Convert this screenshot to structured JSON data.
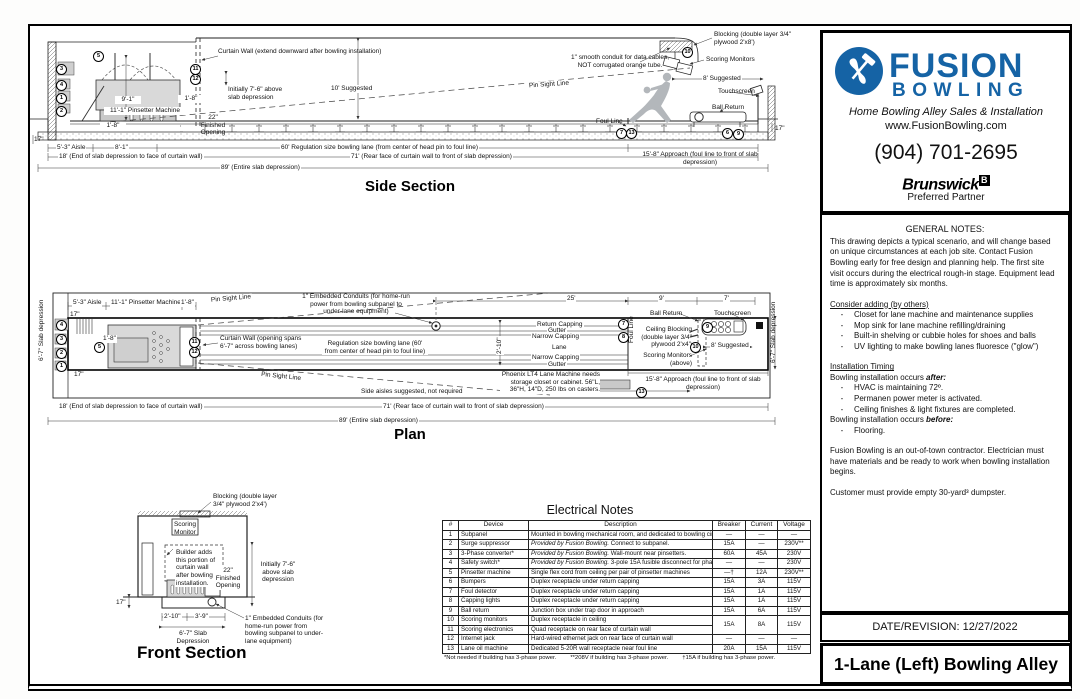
{
  "callouts": {
    "c1": "1",
    "c2": "2",
    "c3": "3",
    "c4": "4",
    "c5": "5",
    "c6": "6",
    "c7": "7",
    "c8": "8",
    "c9": "9",
    "c10": "10",
    "c11": "11",
    "c12": "12",
    "c13": "13"
  },
  "side": {
    "title": "Side Section",
    "curtain_wall": "Curtain Wall (extend downward after bowling installation)",
    "initially": "Initially 7'-6\" above slab depression",
    "dim_9_1": "9'-1\"",
    "pinsetter": "11'-1\" Pinsetter Machine",
    "gap_1_8": "1'-8\"",
    "pit_1_8": "1'-8\"",
    "finished_opening": "22\" Finished Opening",
    "suggested_10": "10' Suggested",
    "pin_sight": "Pin Sight Line",
    "conduit_note": "1\" smooth conduit for data cables, NOT corrugated orange tube.",
    "blocking": "Blocking (double layer 3/4\" plywood 2'x8')",
    "scoring_monitors": "Scoring Monitors",
    "suggested_8": "8' Suggested",
    "touchscreen": "Touchscreen",
    "ball_return": "Ball Return",
    "foul_line": "Foul Line",
    "dim_17_left": "17\"",
    "dim_17_right": "17\"",
    "aisle": "5'-3\" Aisle",
    "dim_8_1": "8'-1\"",
    "lane_60": "60' Regulation size bowling lane (from center of head pin to foul line)",
    "approach": "15'-8\" Approach (foul line to front of slab depression)",
    "dim_18": "18' (End of slab depression to face of curtain wall)",
    "dim_71": "71' (Rear face of curtain wall to front of slab depression)",
    "dim_89": "89' (Entire slab depression)"
  },
  "plan": {
    "title": "Plan",
    "aisle": "5'-3\" Aisle",
    "pinsetter": "11'-1\" Pinsetter Machine",
    "gap_1_8": "1'-8\"",
    "pit_1_8": "1'-8\"",
    "slab_left": "6'-7\" Slab depression",
    "slab_right": "6'-7\" Slab depression",
    "dim_17_top": "17\"",
    "dim_17_bottom": "17\"",
    "pin_sight_upper": "Pin Sight Line",
    "pin_sight_lower": "Pin Sight Line",
    "curtain_wall": "Curtain Wall (opening spans 6'-7\" across bowling lanes)",
    "conduits": "1\" Embedded Conduits (for home-run power from bowling subpanel to under-lane equipment)",
    "dim_25": "25'",
    "dim_9": "9'",
    "dim_7": "7'",
    "return_capping": "Return Capping",
    "gutter_top": "Gutter",
    "narrow_top": "Narrow Capping",
    "lane": "Lane",
    "narrow_bottom": "Narrow Capping",
    "gutter_bottom": "Gutter",
    "reg_lane": "Regulation size bowling lane (60' from center of head pin to foul line)",
    "dim_2_10": "2'-10\"",
    "ball_return": "Ball Return",
    "touchscreen": "Touchscreen",
    "ceiling_blocking": "Ceiling Blocking (double layer 3/4\" plywood 2'x4')",
    "suggested_8": "8' Suggested",
    "scoring_monitors": "Scoring Monitors (above)",
    "foul_line": "Foul Line",
    "approach": "15'-8\" Approach (foul line to front of slab depression)",
    "side_aisles": "Side aisles suggested, not required",
    "phoenix": "Phoenix LT4 Lane Machine needs storage closet or cabinet. 56\"L, 36\"H, 14\"D, 250 lbs on casters.",
    "dim_18": "18' (End of slab depression to face of curtain wall)",
    "dim_71": "71' (Rear face of curtain wall to front of slab depression)",
    "dim_89": "89' (Entire slab depression)"
  },
  "front": {
    "title": "Front Section",
    "blocking": "Blocking (double layer 3/4\" plywood 2'x4')",
    "scoring_monitor": "Scoring Monitor",
    "builder": "Builder adds this portion of curtain wall after bowling installation.",
    "initially": "Initially 7'-6\" above slab depression",
    "finished": "22\" Finished Opening",
    "dim_17": "17\"",
    "dim_2_10": "2'-10\"",
    "dim_3_9": "3'-9\"",
    "slab": "6'-7\" Slab Depression",
    "conduits": "1\" Embedded Conduits (for home-run power from bowling subpanel to under-lane equipment)"
  },
  "electrical": {
    "title": "Electrical Notes",
    "headers": [
      "#",
      "Device",
      "Description",
      "Breaker",
      "Current",
      "Voltage"
    ],
    "rows": [
      {
        "num": "1",
        "device": "Subpanel",
        "desc": "Mounted in bowling mechanical room, and dedicated to bowling circuits only",
        "breaker": "—",
        "current": "—",
        "voltage": "—"
      },
      {
        "num": "2",
        "device": "Surge suppressor",
        "desc_i": "Provided by Fusion Bowling.",
        "desc": " Connect to subpanel.",
        "breaker": "15A",
        "current": "—",
        "voltage": "230V**"
      },
      {
        "num": "3",
        "device": "3-Phase converter*",
        "desc_i": "Provided by Fusion Bowling.",
        "desc": " Wall-mount near pinsetters.",
        "breaker": "60A",
        "current": "45A",
        "voltage": "230V"
      },
      {
        "num": "4",
        "device": "Safety switch*",
        "desc_i": "Provided by Fusion Bowling.",
        "desc": " 3-pole 15A fusible disconnect for phase converter",
        "breaker": "—",
        "current": "—",
        "voltage": "230V"
      },
      {
        "num": "5",
        "device": "Pinsetter machine",
        "desc": "Single flex cord from ceiling per pair of pinsetter machines",
        "breaker": "—†",
        "current": "12A",
        "voltage": "230V**"
      },
      {
        "num": "6",
        "device": "Bumpers",
        "desc": "Duplex receptacle under return capping",
        "breaker": "15A",
        "current": "3A",
        "voltage": "115V"
      },
      {
        "num": "7",
        "device": "Foul detector",
        "desc": "Duplex receptacle under return capping",
        "breaker": "15A",
        "current": "1A",
        "voltage": "115V"
      },
      {
        "num": "8",
        "device": "Capping lights",
        "desc": "Duplex receptacle under return capping",
        "breaker": "15A",
        "current": "1A",
        "voltage": "115V"
      },
      {
        "num": "9",
        "device": "Ball return",
        "desc": "Junction box under trap door in approach",
        "breaker": "15A",
        "current": "6A",
        "voltage": "115V"
      },
      {
        "num": "10",
        "device": "Scoring monitors",
        "desc": "Duplex receptacle in ceiling",
        "breaker": "15A",
        "current": "8A",
        "voltage": "115V"
      },
      {
        "num": "11",
        "device": "Scoring electronics",
        "desc": "Quad receptacle on rear face of curtain wall"
      },
      {
        "num": "12",
        "device": "Internet jack",
        "desc": "Hard-wired ethernet jack on rear face of curtain wall",
        "breaker": "—",
        "current": "—",
        "voltage": "—"
      },
      {
        "num": "13",
        "device": "Lane oil machine",
        "desc": "Dedicated 5-20R wall receptacle near foul line",
        "breaker": "20A",
        "current": "15A",
        "voltage": "115V"
      }
    ],
    "footnote_a": "*Not needed if building has 3-phase power.",
    "footnote_b": "**208V if building has 3-phase power.",
    "footnote_c": "†15A if building has 3-phase power."
  },
  "panel": {
    "brand_top": "FUSION",
    "brand_bottom": "BOWLING",
    "tagline": "Home Bowling Alley Sales & Installation",
    "website": "www.FusionBowling.com",
    "phone": "(904) 701-2695",
    "partner": "Brunswick",
    "partner_mark": "B",
    "partner_sub": "Preferred Partner",
    "date": "DATE/REVISION: 12/27/2022",
    "sheet_title": "1-Lane (Left) Bowling Alley",
    "notes": {
      "dash": "-",
      "heading": "GENERAL NOTES:",
      "intro": "This drawing depicts a typical scenario, and will change based on unique circumstances at each job site. Contact Fusion Bowling early for free design and planning help. The first site visit occurs during the electrical rough-in stage. Equipment lead time is approximately six months.",
      "consider_heading": "Consider adding (by others)",
      "consider_items": [
        "Closet for lane machine and maintenance supplies",
        "Mop sink for lane machine refilling/draining",
        "Built-in shelving or cubbie holes for shoes and balls",
        "UV lighting to make bowling lanes fluoresce (\"glow\")"
      ],
      "timing_heading": "Installation Timing",
      "after_lead": "Bowling installation occurs ",
      "after_word": "after:",
      "after_items": [
        "HVAC is maintaining 72º.",
        "Permanen power meter is activated.",
        "Ceiling finishes & light fixtures are completed."
      ],
      "before_lead": "Bowling installation occurs ",
      "before_word": "before:",
      "before_items": [
        "Flooring."
      ],
      "contractor": "Fusion Bowling is an out-of-town contractor. Electrician must have materials and be ready to work when bowling installation begins.",
      "dumpster": "Customer must provide empty 30-yard³ dumpster."
    }
  }
}
